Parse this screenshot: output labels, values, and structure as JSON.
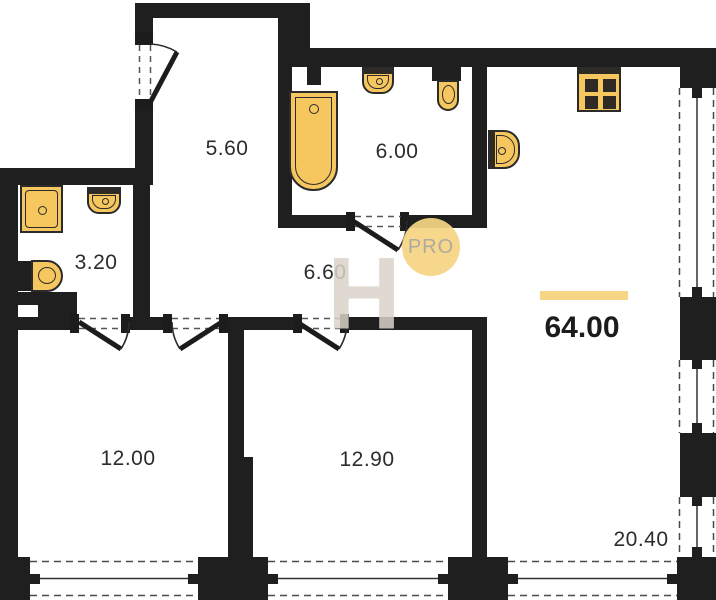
{
  "plan": {
    "title": "apartment-floor-plan",
    "total_area": "64.00",
    "rooms": [
      {
        "id": "hall-upper",
        "area": "5.60"
      },
      {
        "id": "bathroom-large",
        "area": "6.00"
      },
      {
        "id": "bathroom-small",
        "area": "3.20"
      },
      {
        "id": "hall-lower",
        "area": "6.60"
      },
      {
        "id": "bedroom-1",
        "area": "12.00"
      },
      {
        "id": "bedroom-2",
        "area": "12.90"
      },
      {
        "id": "living-kitchen",
        "area": "20.40"
      }
    ],
    "fixtures": [
      "shower-icon",
      "sink-icon",
      "toilet-icon",
      "bathtub-icon",
      "stove-icon",
      "kitchen-sink-icon"
    ],
    "watermark": {
      "letter": "H",
      "badge": "PRO"
    },
    "colors": {
      "wall": "#1F1F1F",
      "fixture": "#F6C65F",
      "accent_bar": "#F6D584",
      "watermark_gray": "#DAD3CA",
      "badge_text": "#A6A59C"
    }
  }
}
